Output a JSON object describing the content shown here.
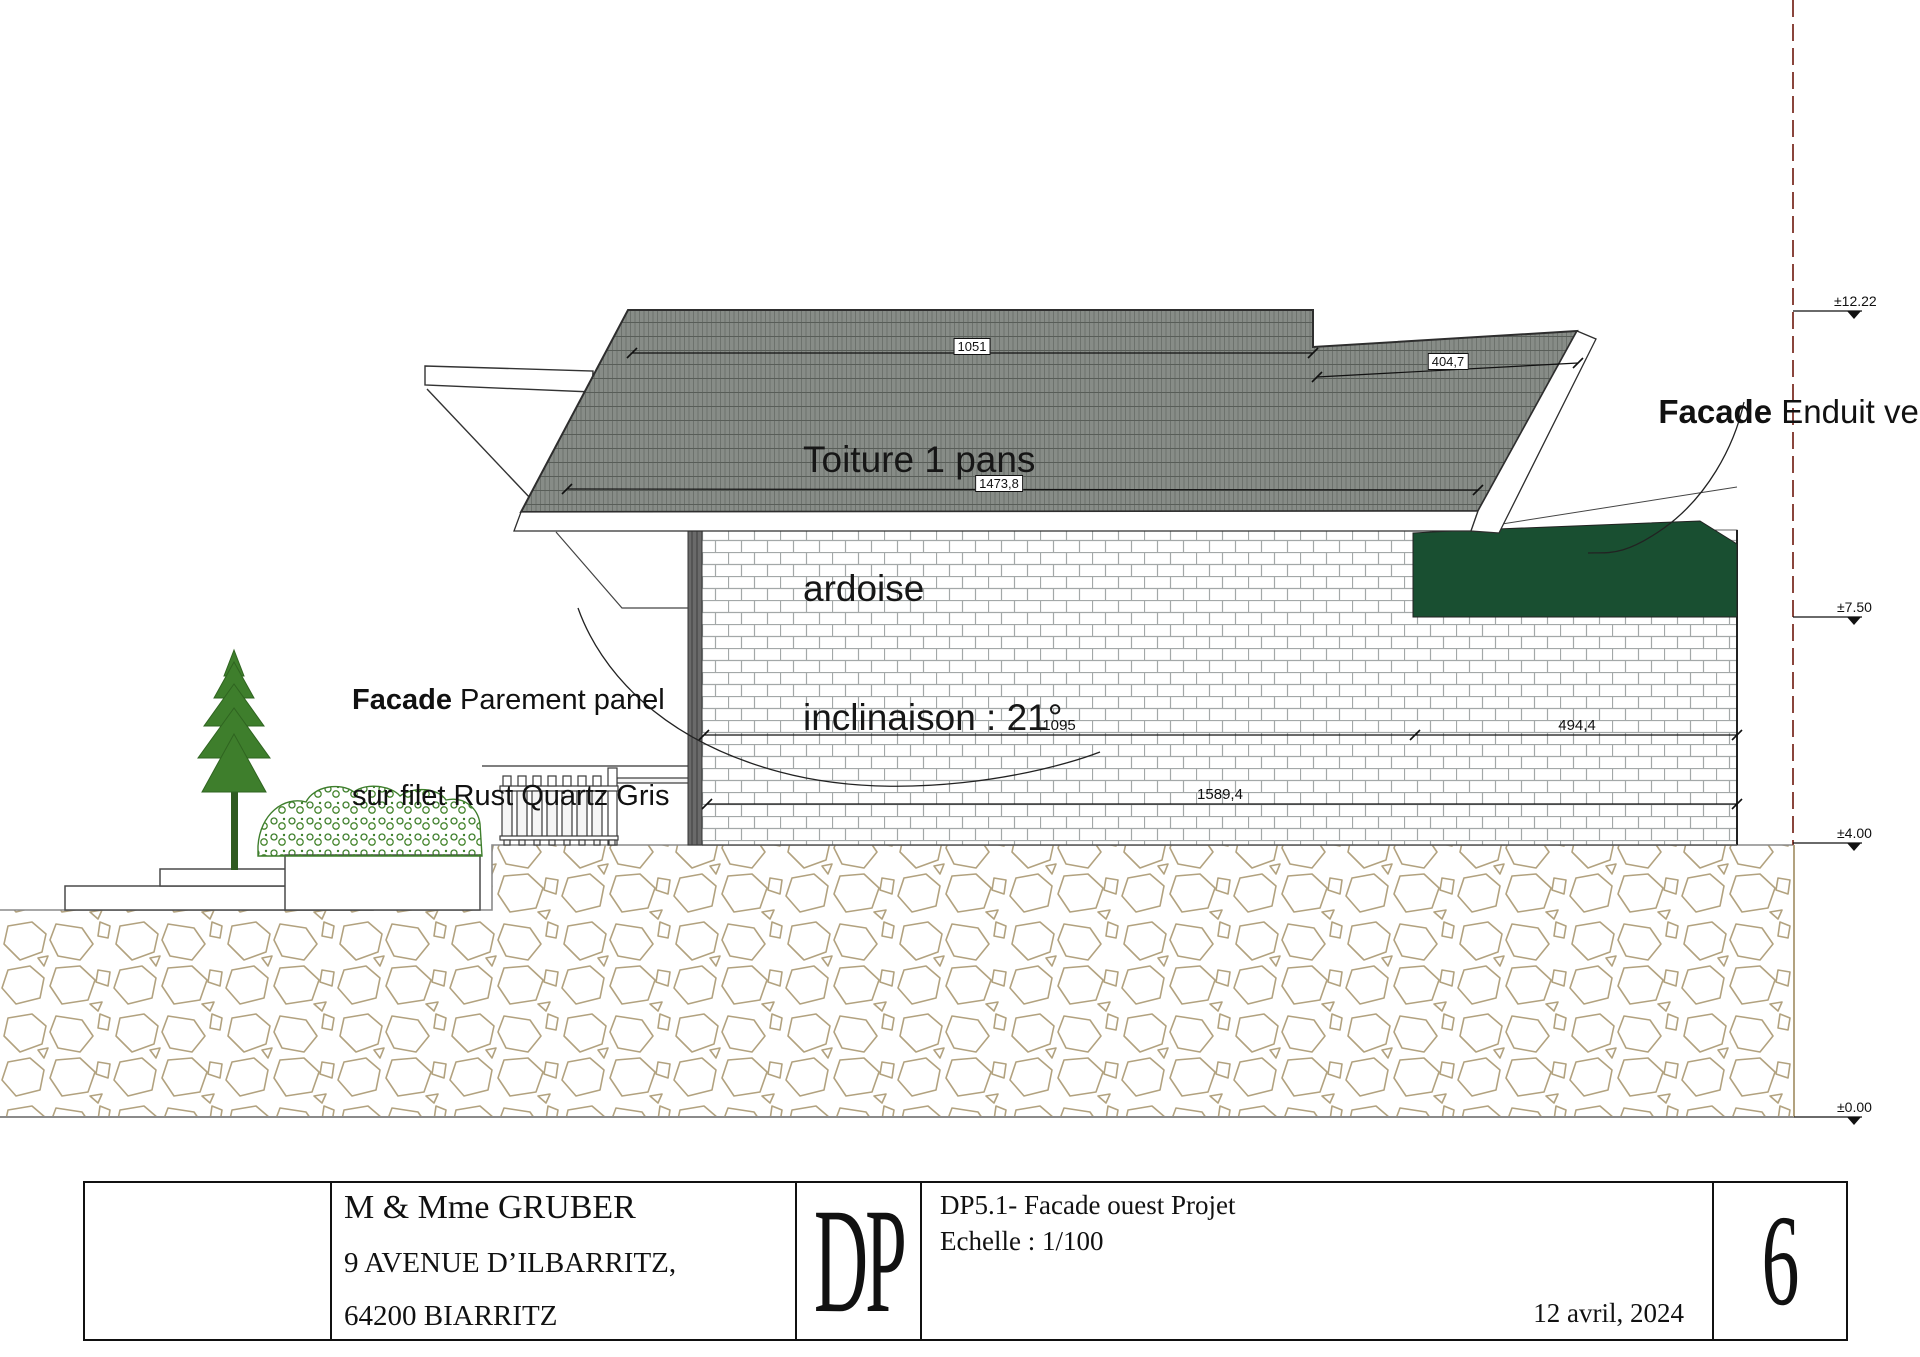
{
  "drawing": {
    "roof_note": {
      "line1": "Toiture 1 pans",
      "line2": "ardoise",
      "line3": "inclinaison : 21°"
    },
    "facade_left": {
      "bold": "Facade",
      "line1_rest": " Parement panel",
      "line2": "sur filet Rust Quartz Gris"
    },
    "facade_right": {
      "bold": "Facade",
      "rest": " Enduit vert"
    },
    "dimensions": {
      "roof_top": "1051",
      "roof_right": "404,7",
      "roof_bottom": "1473,8",
      "wall_left": "1095",
      "wall_right": "494,4",
      "wall_total": "1589,4"
    },
    "levels": [
      {
        "label": "±12.22"
      },
      {
        "label": "±7.50"
      },
      {
        "label": "±4.00"
      },
      {
        "label": "±0.00"
      }
    ],
    "colors": {
      "slate_roof": "#878c87",
      "enduit_vert": "#194f31",
      "axis_dashed": "#8a453c",
      "stone_outline": "#b2a27f",
      "vegetation": "#3e7e2c"
    }
  },
  "title_block": {
    "client": "M & Mme   GRUBER",
    "address1": "9 AVENUE D’ILBARRITZ,",
    "address2": "64200 BIARRITZ",
    "logo": "DP",
    "doc_title": "DP5.1- Facade ouest Projet",
    "scale": "Echelle : 1/100",
    "date": "12 avril,  2024",
    "page_number": "6"
  }
}
